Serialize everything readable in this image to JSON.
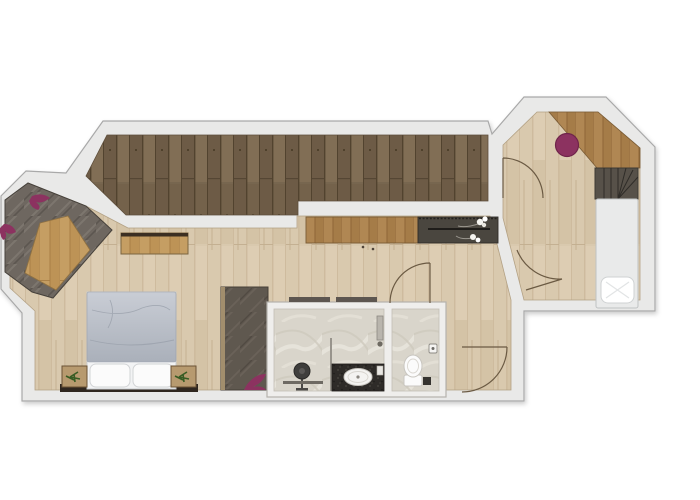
{
  "title": "apartment-floor-plan",
  "palette": {
    "background": "#ffffff",
    "wall": "#e9e9e8",
    "wall_line": "#a9a9a9",
    "terrace_wood": "#77664f",
    "terrace_wood_dark": "#5e4e3b",
    "floor_wood": "#d9c9ae",
    "floor_wood_line": "#c6b294",
    "honey_wood": "#c59e63",
    "mid_wood": "#b08753",
    "counter_dark": "#4a463f",
    "closet_dark": "#6e6760",
    "wardrobe_dark": "#5f584f",
    "marble": "#d9d5cb",
    "marble_vein": "#e8e5dc",
    "tile_dark": "#2e2b28",
    "duvet_light": "#c9cdd5",
    "duvet_dark": "#aab0ba",
    "linen_white": "#fbfbfb",
    "bed_white": "#e9eaea",
    "accent_magenta": "#8c3260",
    "plant_green": "#375c23",
    "stairs_dark": "#575149",
    "door_line": "#6b5a43",
    "fixture_white": "#f4f3f1",
    "fixture_line": "#c6c3bd",
    "dark_strip": "#30271f"
  },
  "rooms": [
    {
      "name": "terrace-deck",
      "floor": "dark-wood"
    },
    {
      "name": "walk-in-closet",
      "floor": "dark-counter-over-honey-wood"
    },
    {
      "name": "bedroom-living-area",
      "floor": "light-wood"
    },
    {
      "name": "bathroom",
      "floor": "marble"
    },
    {
      "name": "wc",
      "floor": "marble"
    },
    {
      "name": "entry-corridor",
      "floor": "light-wood"
    },
    {
      "name": "second-bedroom",
      "floor": "light-wood"
    }
  ],
  "furniture": [
    "double-bed-with-pillows",
    "nightstand-left",
    "nightstand-right",
    "wardrobe-tall",
    "sideboard-bench",
    "kitchen-counter-wood",
    "kitchen-counter-dark-with-flowers",
    "freestanding-tub",
    "vanity-mirror",
    "towel-rail",
    "toilet",
    "shower-partition",
    "single-bed-with-pillow",
    "winder-staircase",
    "round-lounge-chair",
    "decorative-plants"
  ],
  "doors": {
    "count": 5,
    "style": "quarter-circle-swing-arcs"
  }
}
